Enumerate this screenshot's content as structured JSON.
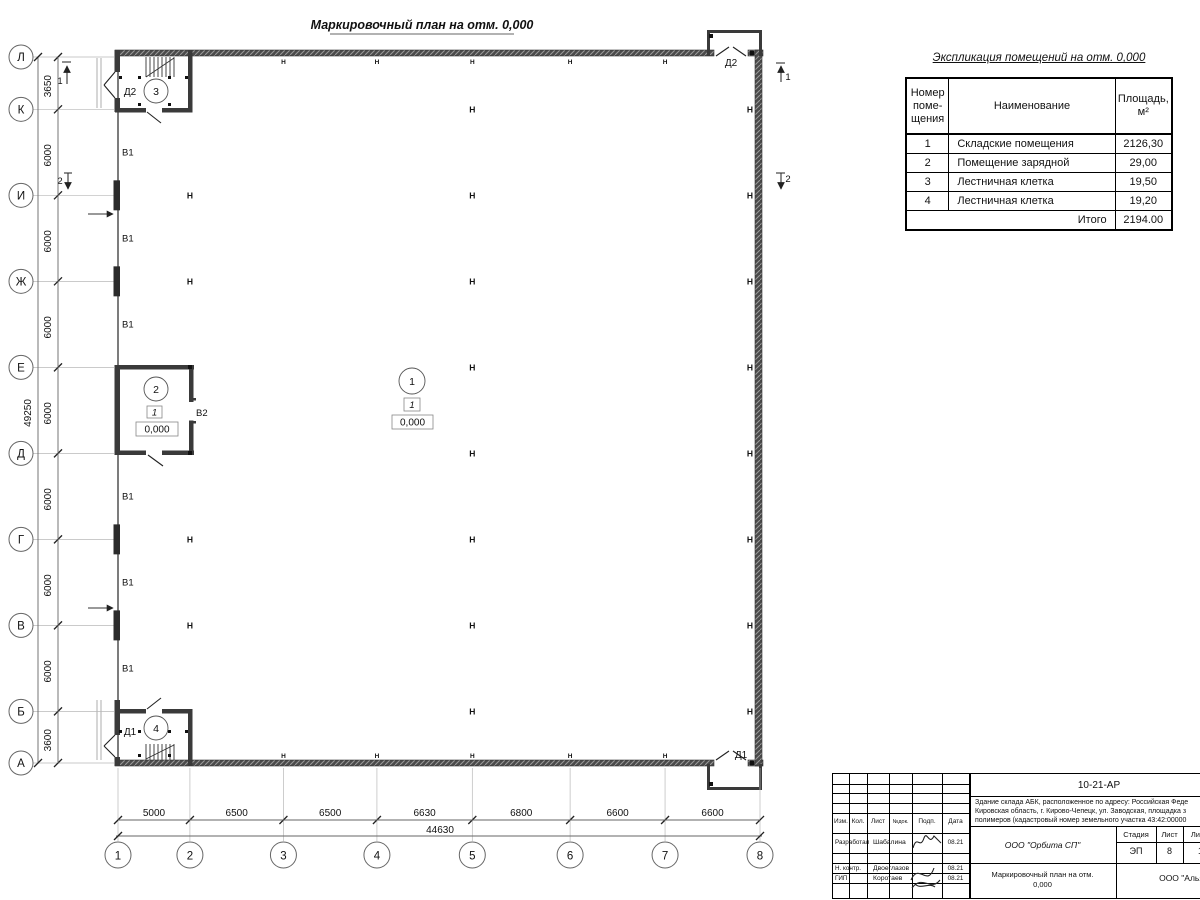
{
  "plan": {
    "sheet_title": "Маркировочный план на отм. 0,000",
    "row_axes": [
      "Л",
      "К",
      "И",
      "Ж",
      "Е",
      "Д",
      "Г",
      "В",
      "Б",
      "А"
    ],
    "row_dims": [
      "3650",
      "6000",
      "6000",
      "6000",
      "6000",
      "6000",
      "6000",
      "6000",
      "3600"
    ],
    "row_total": "49250",
    "col_axes": [
      "1",
      "2",
      "3",
      "4",
      "5",
      "6",
      "7",
      "8"
    ],
    "col_dims": [
      "5000",
      "6500",
      "6500",
      "6630",
      "6800",
      "6600",
      "6600"
    ],
    "col_total": "44630",
    "column_glyph": "Н",
    "h_interior": [
      {
        "col": "2",
        "rows": [
          "И",
          "Ж",
          "Г",
          "В"
        ]
      },
      {
        "col": "5",
        "rows": [
          "К",
          "И",
          "Ж",
          "Е",
          "Д",
          "Г",
          "В",
          "Б"
        ]
      }
    ],
    "h_right_wall_rows": [
      "К",
      "И",
      "Ж",
      "Е",
      "Д",
      "Г",
      "В",
      "Б"
    ],
    "h_top_wall_cols": [
      "3",
      "4",
      "5",
      "6",
      "7"
    ],
    "h_bottom_wall_cols": [
      "3",
      "4",
      "5",
      "6",
      "7"
    ],
    "window_label": "В1",
    "windows_between_rows": [
      [
        "К",
        "И"
      ],
      [
        "И",
        "Ж"
      ],
      [
        "Ж",
        "Е"
      ],
      [
        "Д",
        "Г"
      ],
      [
        "Г",
        "В"
      ],
      [
        "В",
        "Б"
      ]
    ],
    "gate_label": "В2",
    "pilaster_rows": [
      "И",
      "Ж",
      "Г",
      "В"
    ],
    "doors": {
      "top_left": "Д2",
      "top_right": "Д2",
      "bottom_left": "Д1",
      "bottom_right": "Д1"
    },
    "section_marks": {
      "left_top": "1",
      "left_mid": "2",
      "right_top": "1",
      "right_mid": "2"
    },
    "rooms": {
      "r1": {
        "number": "1",
        "floor": "1",
        "elevation": "0,000"
      },
      "r2": {
        "number": "2",
        "floor": "1",
        "elevation": "0,000"
      },
      "r3": {
        "number": "3"
      },
      "r4": {
        "number": "4"
      }
    }
  },
  "explication": {
    "title": "Экспликация помещений на отм. 0,000",
    "col1_header_lines": [
      "Номер",
      "поме-",
      "щения"
    ],
    "col2_header": "Наименование",
    "col3_header_lines": [
      "Площадь,",
      "м²"
    ],
    "rows": [
      {
        "num": "1",
        "name": "Складские помещения",
        "area": "2126,30"
      },
      {
        "num": "2",
        "name": "Помещение зарядной",
        "area": "29,00"
      },
      {
        "num": "3",
        "name": "Лестничная клетка",
        "area": "19,50"
      },
      {
        "num": "4",
        "name": "Лестничная клетка",
        "area": "19,20"
      }
    ],
    "total_label": "Итого",
    "total_value": "2194.00"
  },
  "titleblock": {
    "doc_number": "10-21-АР",
    "description_lines": [
      "Здание склада АБК, расположенное по адресу: Российская Феде",
      "Кировская область, г. Кирово-Чепецк, ул. Заводская, площадка з",
      "полимеров (кадастровый номер земельного участка 43:42:00000"
    ],
    "cols": [
      "Изм.",
      "Кол.",
      "Лист",
      "№док.",
      "Подп.",
      "Дата"
    ],
    "sign_rows": [
      {
        "role": "Разработал",
        "name": "Шабалина",
        "date": "08.21"
      },
      {
        "role": "Н. контр.",
        "name": "Двоеглазов",
        "date": "08.21"
      },
      {
        "role": "ГИП",
        "name": "Коротаев",
        "date": "08.21"
      }
    ],
    "company": "ООО \"Орбита СП\"",
    "stage_label": "Стадия",
    "sheet_label": "Лист",
    "sheets_label": "Листов",
    "stage": "ЭП",
    "sheet": "8",
    "sheets": "17",
    "drawing_title_lines": [
      "Маркировочный план на отм.",
      "0,000"
    ],
    "contractor": "ООО \"Альянс"
  }
}
